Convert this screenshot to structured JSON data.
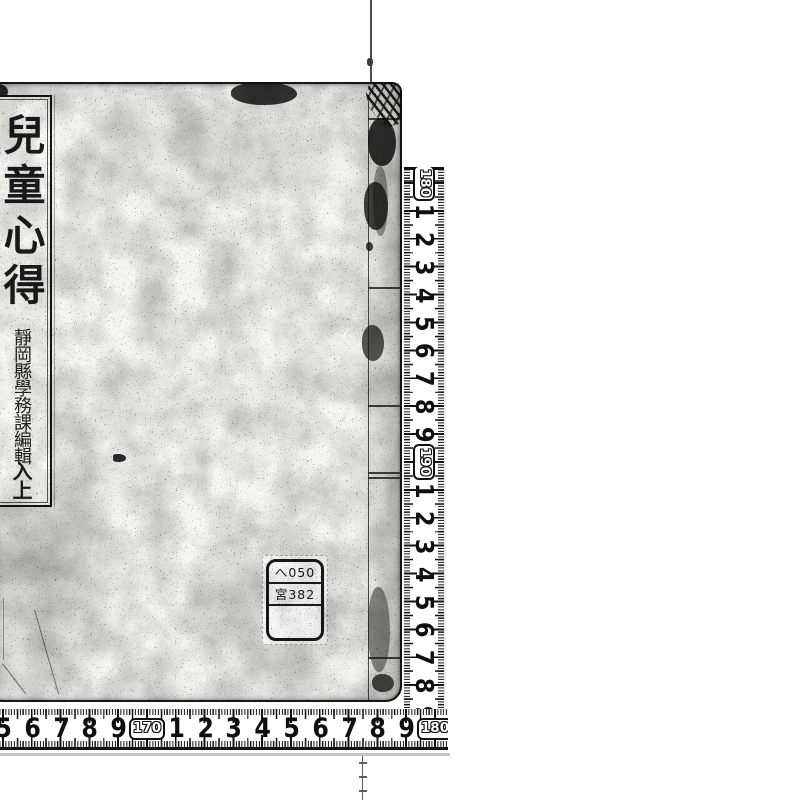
{
  "page": {
    "background": "#ffffff"
  },
  "book_cover": {
    "title_slip": {
      "title": "兒童心得",
      "imprint": "靜岡縣學務課編輯",
      "volume_mark": "入上"
    },
    "call_number_label": {
      "line1": "へ050",
      "line2": "宮382",
      "line3": ""
    }
  },
  "rulers": {
    "vertical": {
      "labels": [
        "180",
        "1",
        "2",
        "3",
        "4",
        "5",
        "6",
        "7",
        "8",
        "9",
        "190",
        "1",
        "2",
        "3",
        "4",
        "5",
        "6",
        "7",
        "8",
        "9"
      ]
    },
    "horizontal": {
      "labels": [
        "5",
        "6",
        "7",
        "8",
        "9",
        "170",
        "1",
        "2",
        "3",
        "4",
        "5",
        "6",
        "7",
        "8",
        "9",
        "180"
      ]
    }
  },
  "colors": {
    "ink": "#141414",
    "cover_paper": "#f5f5f2",
    "scan_background": "#ffffff"
  }
}
